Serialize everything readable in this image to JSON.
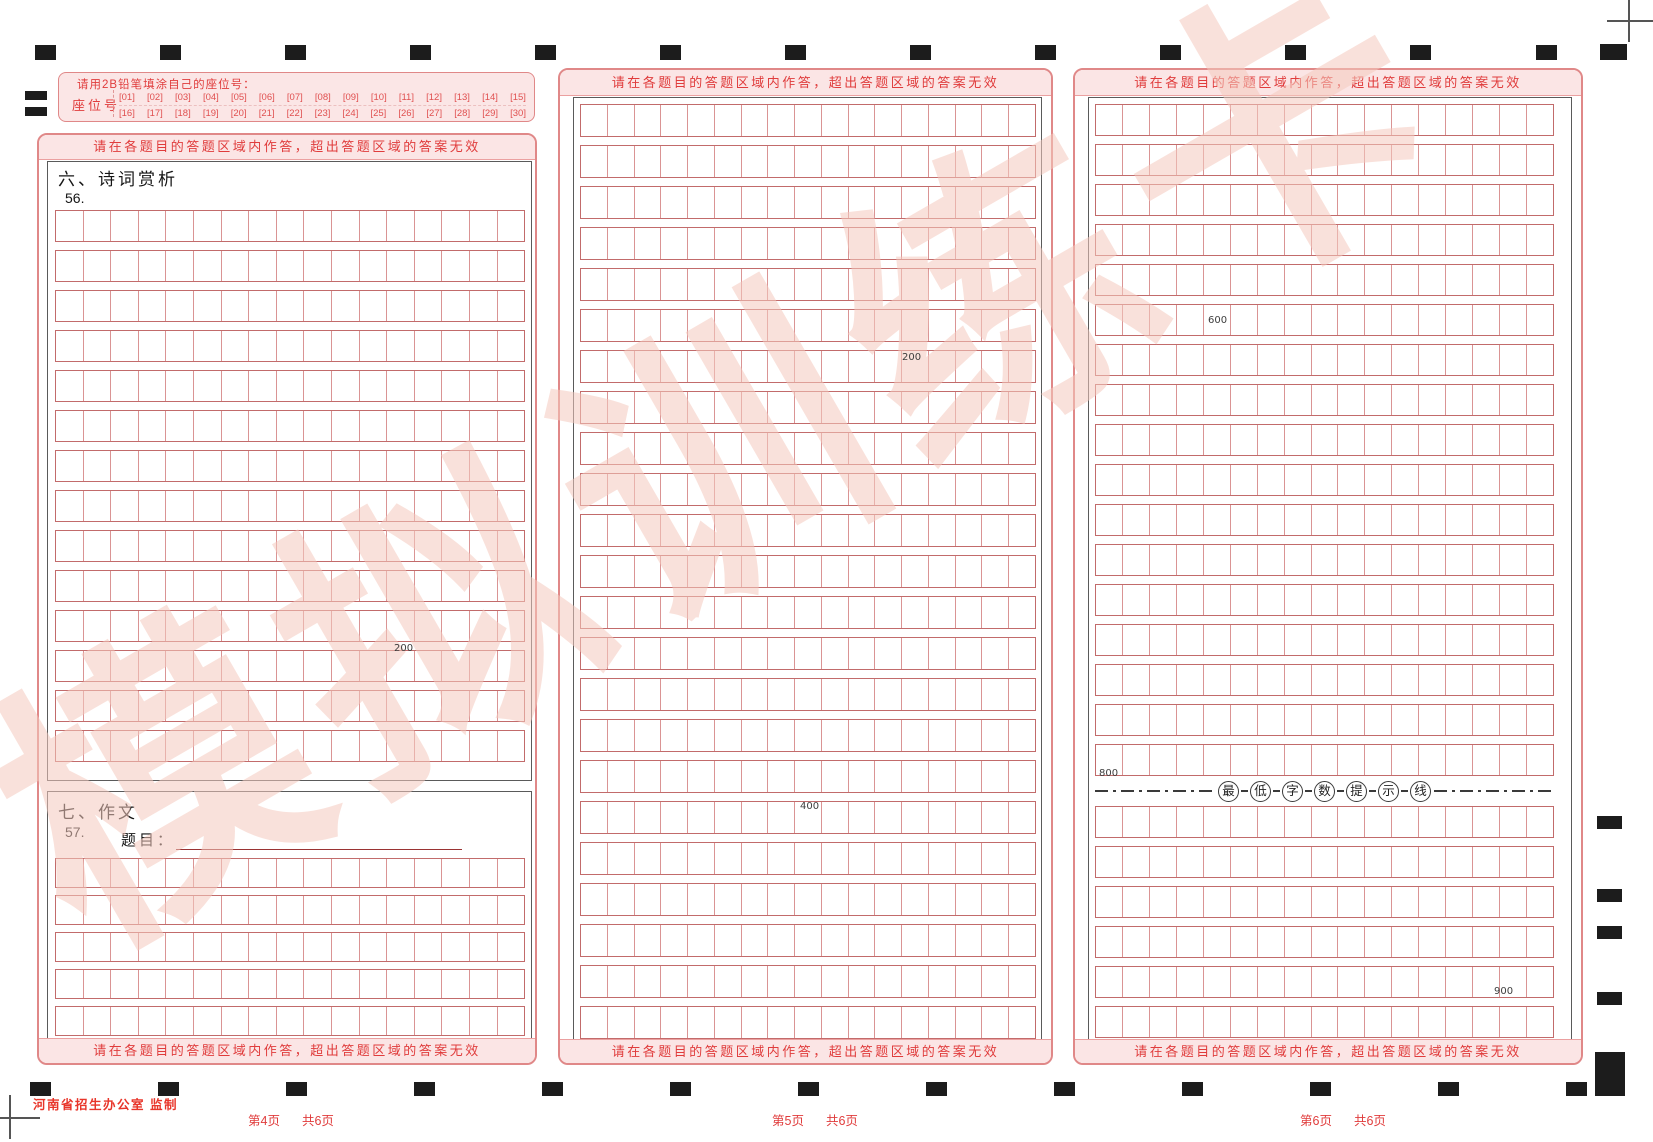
{
  "watermark": "模拟训练卡",
  "warning": "请在各题目的答题区域内作答，超出答题区域的答案无效",
  "publisher": "河南省招生办公室 监制",
  "seat": {
    "instruction": "请用2B铅笔填涂自己的座位号：",
    "label": "座位号",
    "row1": [
      "[01]",
      "[02]",
      "[03]",
      "[04]",
      "[05]",
      "[06]",
      "[07]",
      "[08]",
      "[09]",
      "[10]",
      "[11]",
      "[12]",
      "[13]",
      "[14]",
      "[15]"
    ],
    "row2": [
      "[16]",
      "[17]",
      "[18]",
      "[19]",
      "[20]",
      "[21]",
      "[22]",
      "[23]",
      "[24]",
      "[25]",
      "[26]",
      "[27]",
      "[28]",
      "[29]",
      "[30]"
    ]
  },
  "sections": {
    "s6": {
      "title": "六、诗词赏析",
      "qnum": "56."
    },
    "s7": {
      "title": "七、作文",
      "qnum": "57.",
      "field_label": "题目："
    }
  },
  "pages": {
    "left": {
      "current": "第4页",
      "total": "共6页"
    },
    "middle": {
      "current": "第5页",
      "total": "共6页"
    },
    "right": {
      "current": "第6页",
      "total": "共6页"
    }
  },
  "min_line": {
    "chars": [
      "最",
      "低",
      "字",
      "数",
      "提",
      "示",
      "线"
    ]
  },
  "counters": [
    {
      "text": "200",
      "x": 394,
      "y": 643
    },
    {
      "text": "200",
      "x": 902,
      "y": 352
    },
    {
      "text": "400",
      "x": 800,
      "y": 801
    },
    {
      "text": "600",
      "x": 1208,
      "y": 315
    },
    {
      "text": "800",
      "x": 1099,
      "y": 768
    },
    {
      "text": "900",
      "x": 1494,
      "y": 986
    }
  ],
  "grids": {
    "q56": {
      "rows": 14,
      "cols": 17
    },
    "q57": {
      "rows": 5,
      "cols": 17
    },
    "middle": {
      "rows": 23,
      "cols": 17
    },
    "right_top": {
      "rows": 17,
      "cols": 17
    },
    "right_bottom": {
      "rows": 6,
      "cols": 17
    }
  },
  "colors": {
    "accent_red": "#e03c3c",
    "pink_border": "#e08888",
    "pink_bg": "#fbe5e5",
    "grid_line": "#da9494",
    "row_line": "#c26b6b",
    "watermark_pink": "#f5cabe"
  }
}
